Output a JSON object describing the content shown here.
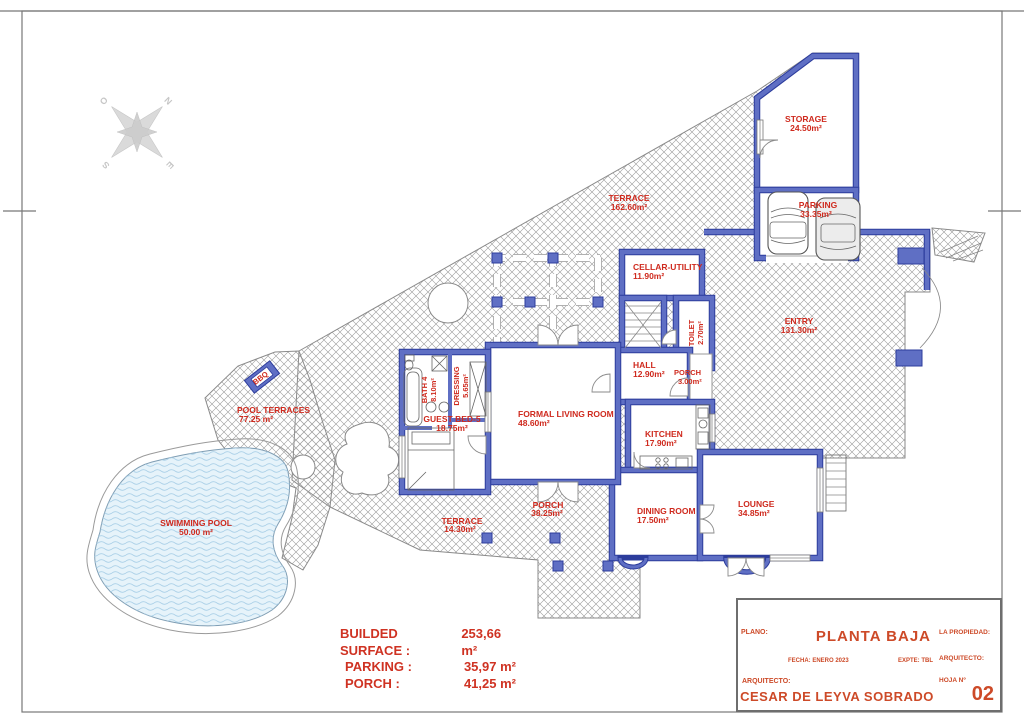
{
  "rooms": {
    "storage": {
      "name": "STORAGE",
      "area": "24.50m²"
    },
    "terrace_top": {
      "name": "TERRACE",
      "area": "162.60m²"
    },
    "parking": {
      "name": "PARKING",
      "area": "33.35m²"
    },
    "cellar_utility": {
      "name": "CELLAR-UTILITY",
      "area": "11.90m²"
    },
    "entry": {
      "name": "ENTRY",
      "area": "131.30m²"
    },
    "toilet": {
      "name": "TOILET",
      "area": "2.70m²"
    },
    "hall": {
      "name": "HALL",
      "area": "12.90m²"
    },
    "porch_hall": {
      "name": "PORCH",
      "area": "3.00m²"
    },
    "kitchen": {
      "name": "KITCHEN",
      "area": "17.90m²"
    },
    "formal_living": {
      "name": "FORMAL LIVING ROOM",
      "area": "48.60m²"
    },
    "guest_bed": {
      "name": "GUEST BED-5",
      "area": "18.75m²"
    },
    "bath4": {
      "name": "BATH 4",
      "area": "8.10m²"
    },
    "dressing": {
      "name": "DRESSING",
      "area": "5.65m²"
    },
    "dining": {
      "name": "DINING ROOM",
      "area": "17.50m²"
    },
    "lounge": {
      "name": "LOUNGE",
      "area": "34.85m²"
    },
    "pool_terraces": {
      "name": "POOL TERRACES",
      "area": "77.25 m²"
    },
    "swimming_pool": {
      "name": "SWIMMING POOL",
      "area": "50.00 m²"
    },
    "terrace_bottom": {
      "name": "TERRACE",
      "area": "14.30m²"
    },
    "porch_bottom": {
      "name": "PORCH",
      "area": "38.25m²"
    },
    "bbq": {
      "name": "BBQ"
    }
  },
  "compass": {
    "letters": [
      "N",
      "E",
      "S",
      "O"
    ]
  },
  "summary": {
    "rows": [
      {
        "label": "BUILDED SURFACE :",
        "value": "253,66 m²"
      },
      {
        "label": "PARKING :",
        "value": "35,97 m²"
      },
      {
        "label": "PORCH :",
        "value": "41,25 m²"
      }
    ]
  },
  "title_block": {
    "plano_label": "PLANO:",
    "plano_value": "PLANTA BAJA",
    "propiedad_label": "LA PROPIEDAD:",
    "arquitecto_side_label": "ARQUITECTO:",
    "fecha": "FECHA: ENERO 2023",
    "expte": "EXPTE: TBL",
    "arquitecto_label": "ARQUITECTO:",
    "arquitecto_value": "CESAR DE LEYVA SOBRADO",
    "hoja_label": "HOJA Nº",
    "hoja_value": "02"
  },
  "colors": {
    "wall_fill": "#5f6fc4",
    "wall_edge": "#2c3c9c",
    "label_red": "#cf2a1e",
    "title_red": "#cd4a28",
    "pool_fill": "#e6f3fa",
    "pool_wave": "#a9cfe7"
  }
}
